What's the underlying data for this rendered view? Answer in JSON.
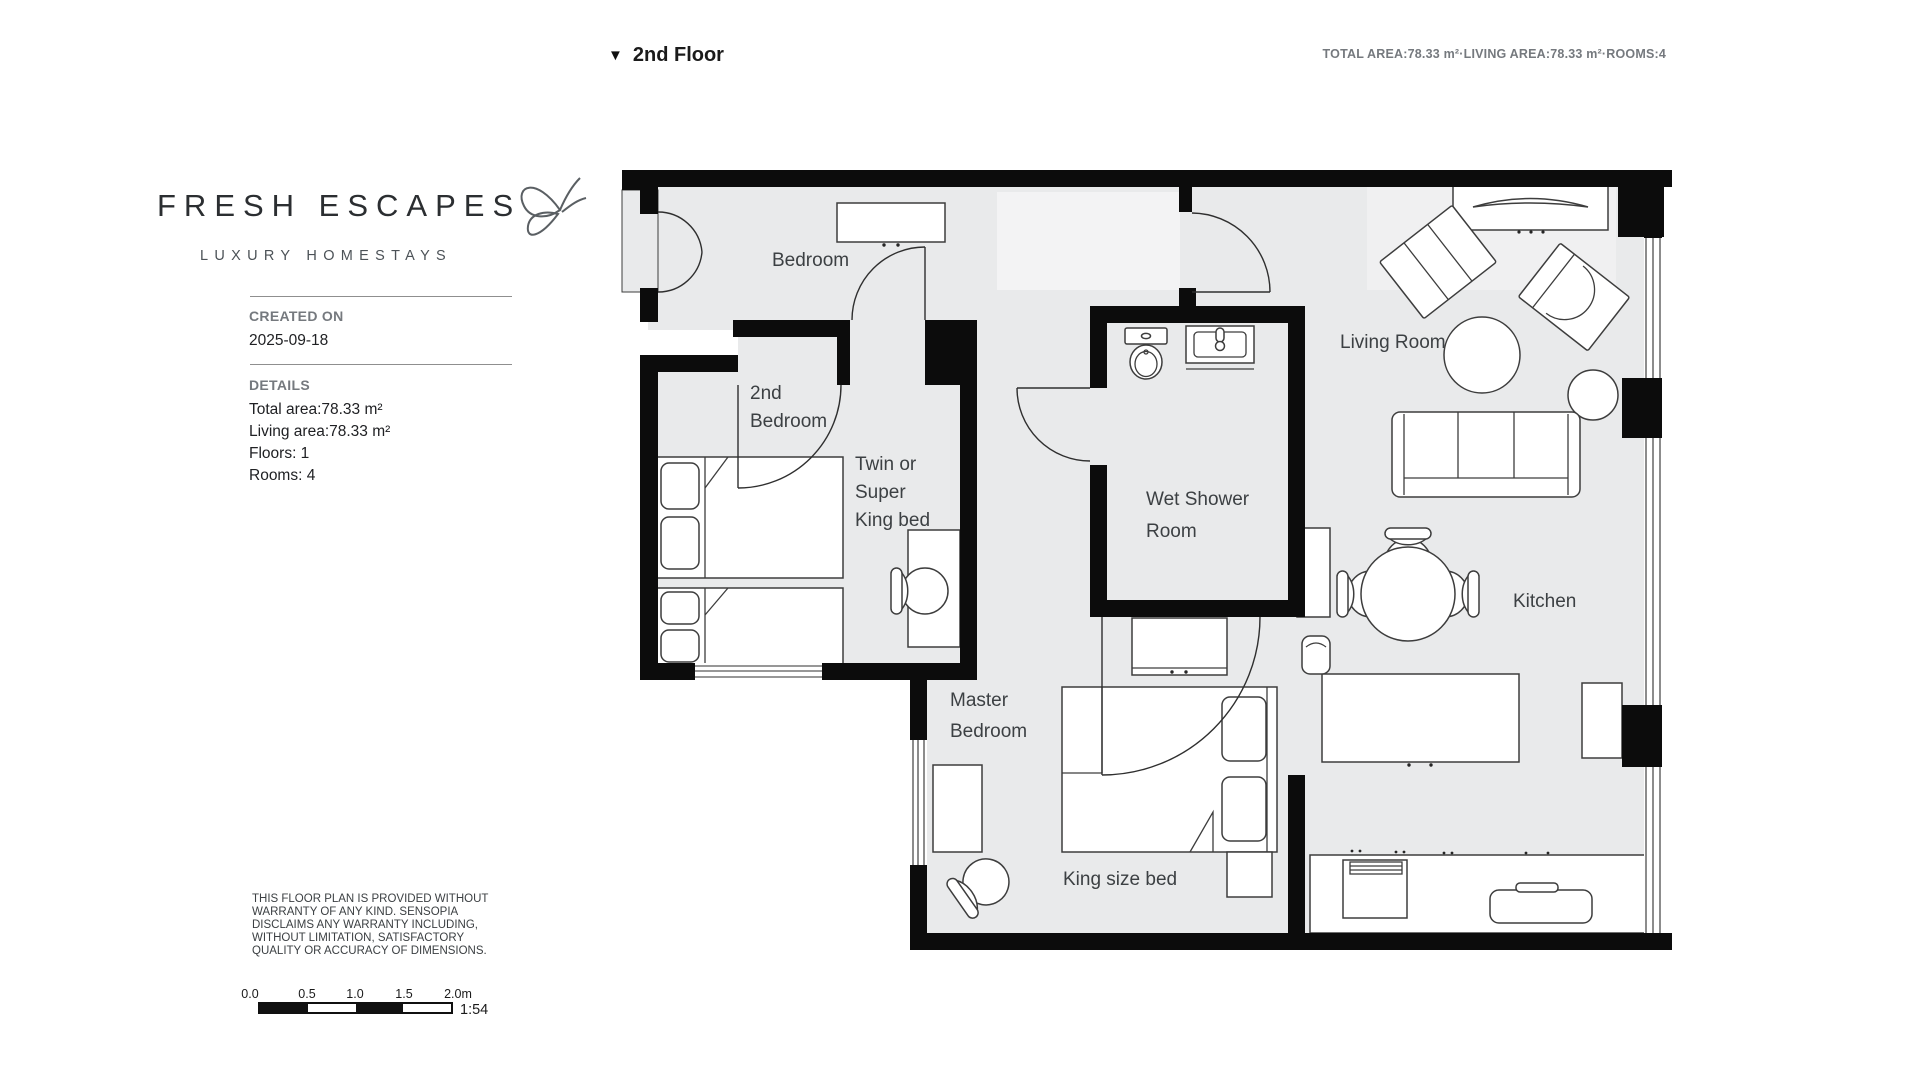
{
  "header": {
    "floor_icon": "▼",
    "floor_label": "2nd Floor",
    "summary": "TOTAL AREA:78.33 m²·LIVING AREA:78.33 m²·ROOMS:4"
  },
  "branding": {
    "name": "FRESH ESCAPES",
    "tagline": "LUXURY HOMESTAYS",
    "logo_icon": "butterfly-outline"
  },
  "sidebar": {
    "created_on_label": "CREATED ON",
    "created_on_value": "2025-09-18",
    "details_label": "DETAILS",
    "details": [
      "Total area:78.33 m²",
      "Living area:78.33 m²",
      "Floors: 1",
      "Rooms: 4"
    ],
    "disclaimer": "THIS FLOOR PLAN IS PROVIDED WITHOUT WARRANTY OF ANY KIND. SENSOPIA DISCLAIMS ANY WARRANTY INCLUDING, WITHOUT LIMITATION, SATISFACTORY QUALITY OR ACCURACY OF DIMENSIONS."
  },
  "scalebar": {
    "labels": [
      "0.0",
      "0.5",
      "1.0",
      "1.5",
      "2.0m"
    ],
    "ratio": "1:54",
    "segment_colors": [
      "#111111",
      "#ffffff",
      "#111111",
      "#ffffff"
    ]
  },
  "plan": {
    "labels": {
      "bedroom": "Bedroom",
      "second_bedroom": [
        "2nd",
        "Bedroom"
      ],
      "twin_bed": [
        "Twin or",
        "Super",
        "King bed"
      ],
      "wet_shower": [
        "Wet Shower",
        "Room"
      ],
      "living_room": "Living Room",
      "master_bedroom": [
        "Master",
        "Bedroom"
      ],
      "king_bed": "King size bed",
      "kitchen": "Kitchen"
    }
  },
  "colors": {
    "wall": "#0c0c0c",
    "floor": "#e9eaeb",
    "entry_mat": "#f3f3f4",
    "living_rug": "#f0f0f1",
    "furniture_fill": "#ffffff",
    "furniture_stroke": "#3d3d3d",
    "label_text": "#3c4043",
    "muted_text": "#75797e"
  }
}
